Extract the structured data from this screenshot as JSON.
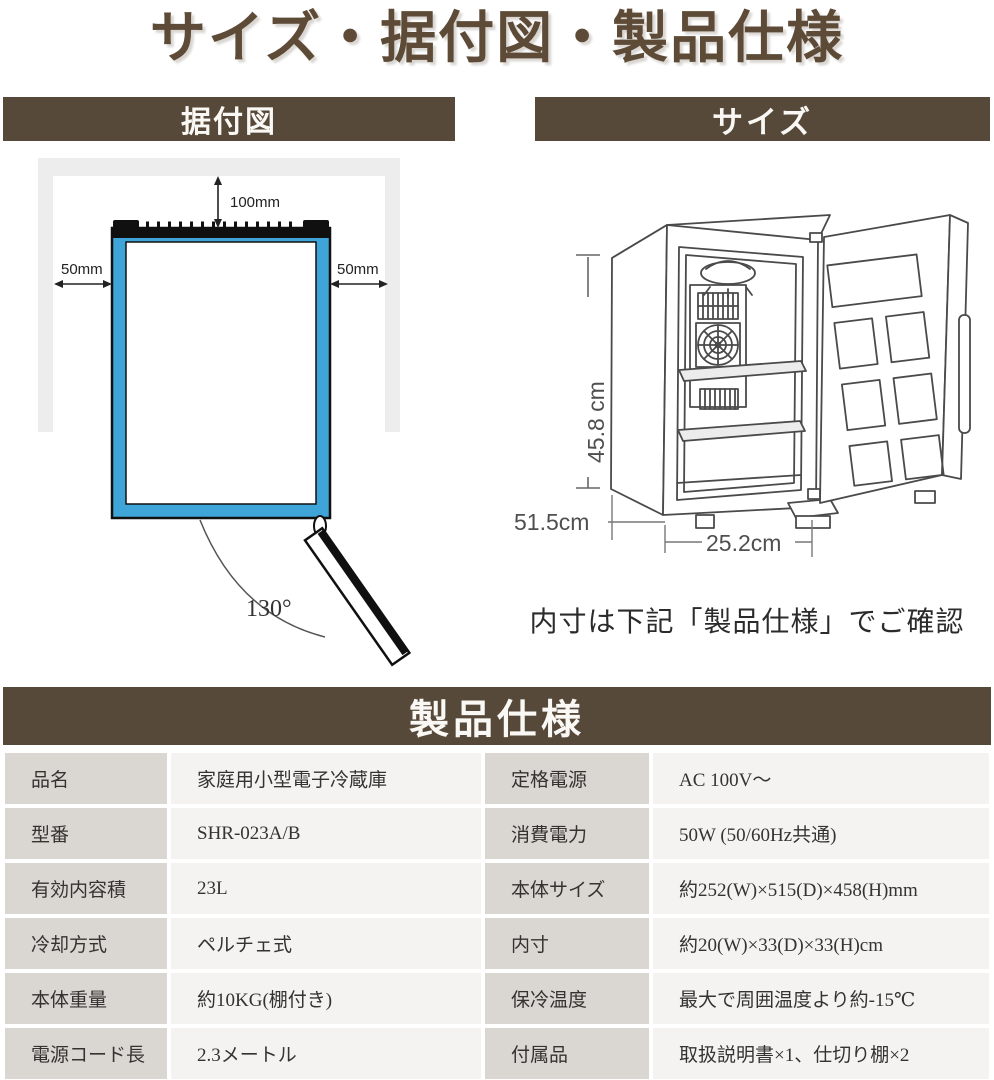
{
  "title": "サイズ・据付図・製品仕様",
  "installation": {
    "header": "据付図",
    "top_clearance": "100mm",
    "left_clearance": "50mm",
    "right_clearance": "50mm",
    "door_open_angle": "130°"
  },
  "size": {
    "header": "サイズ",
    "height": "45.8 cm",
    "depth": "51.5cm",
    "width": "25.2cm",
    "note": "内寸は下記「製品仕様」でご確認"
  },
  "specs": {
    "header": "製品仕様",
    "rows": [
      {
        "label_left": "品名",
        "value_left": "家庭用小型電子冷蔵庫",
        "label_right": "定格電源",
        "value_right": "AC 100V〜"
      },
      {
        "label_left": "型番",
        "value_left": "SHR-023A/B",
        "label_right": "消費電力",
        "value_right": "50W (50/60Hz共通)"
      },
      {
        "label_left": "有効内容積",
        "value_left": "23L",
        "label_right": "本体サイズ",
        "value_right": "約252(W)×515(D)×458(H)mm"
      },
      {
        "label_left": "冷却方式",
        "value_left": "ペルチェ式",
        "label_right": "内寸",
        "value_right": "約20(W)×33(D)×33(H)cm"
      },
      {
        "label_left": "本体重量",
        "value_left": "約10KG(棚付き)",
        "label_right": "保冷温度",
        "value_right": "最大で周囲温度より約-15℃"
      },
      {
        "label_left": "電源コード長",
        "value_left": "2.3メートル",
        "label_right": "付属品",
        "value_right": "取扱説明書×1、仕切り棚×2"
      }
    ]
  },
  "colors": {
    "section_bar_brown": "#57493a",
    "title_brown": "#5d4b37",
    "fridge_blue": "#3fa5d8",
    "wall_gray": "#ededed",
    "table_label_bg": "#dad7d2",
    "table_value_bg": "#f4f3f1"
  }
}
